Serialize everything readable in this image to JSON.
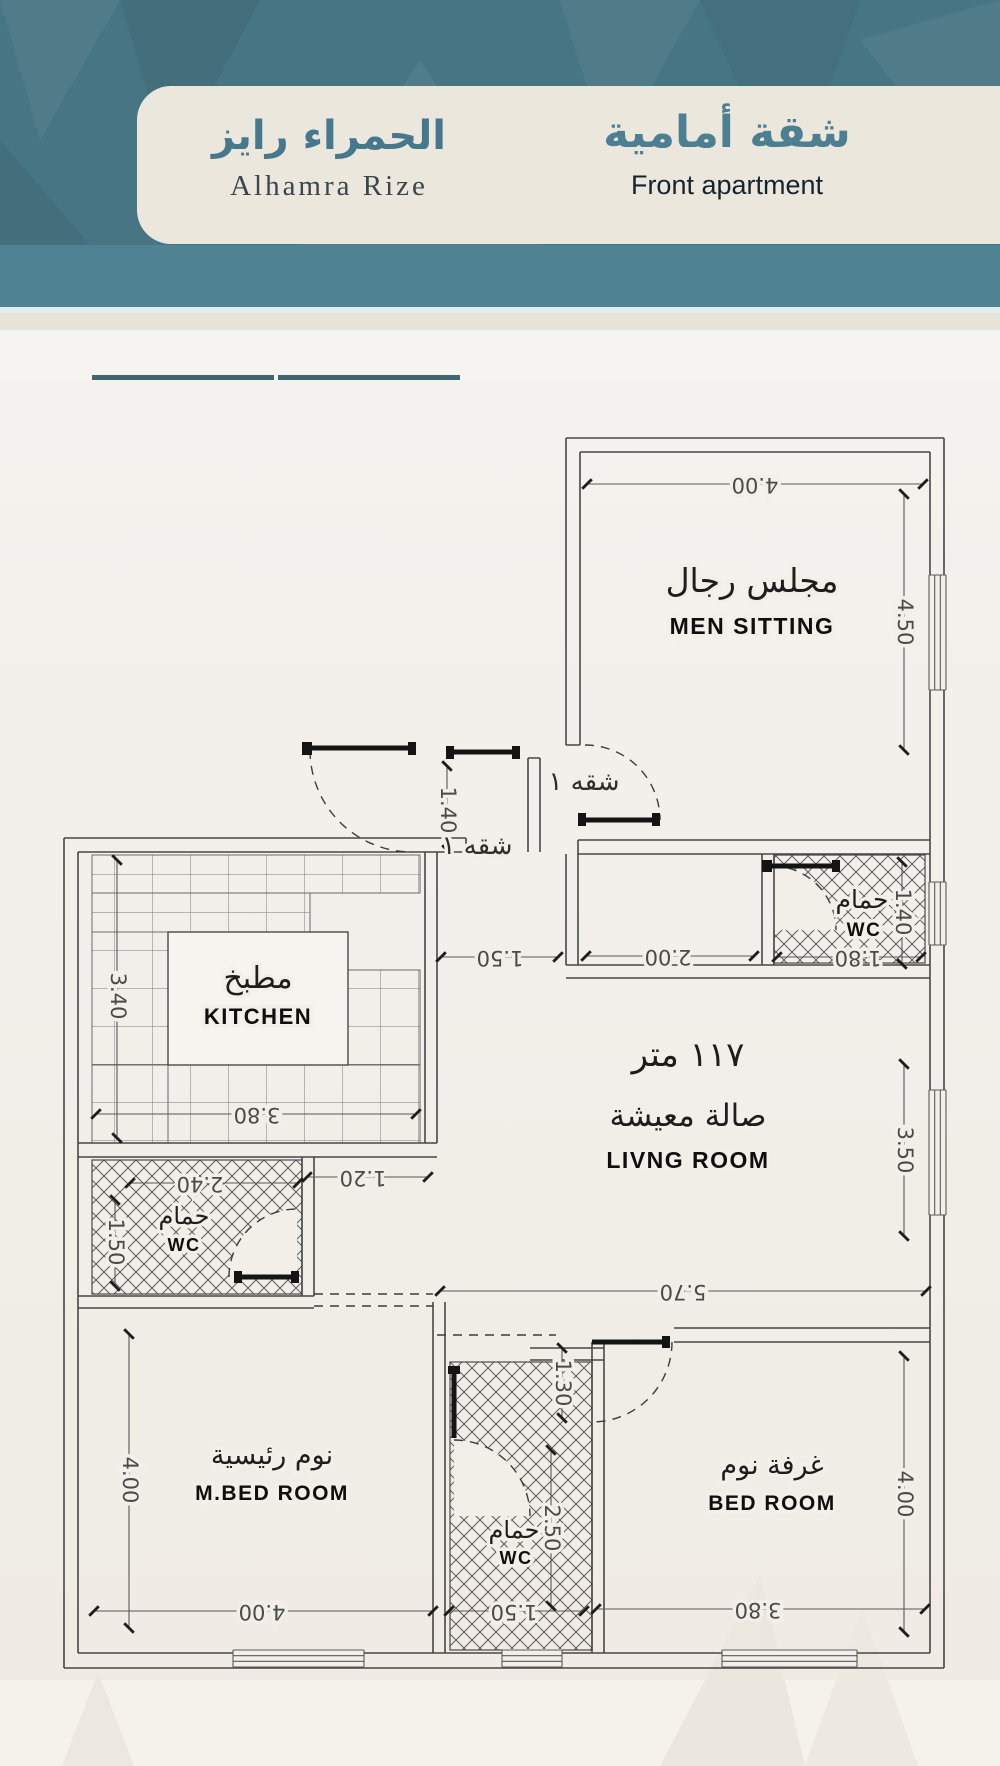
{
  "header": {
    "project_ar": "الحمراء رايز",
    "project_en": "Alhamra Rize",
    "unit_ar": "شقة أمامية",
    "unit_en": "Front apartment"
  },
  "stats": {
    "price": {
      "header": "المساحة",
      "value": "570",
      "unit": "ألف"
    },
    "area": {
      "header": "المساحة",
      "value": "120",
      "unit": "متر مربع"
    }
  },
  "features": {
    "rows": [
      {
        "right": {
          "icon": "room-3d-icon",
          "label": "3 غــــــرف"
        },
        "left": {
          "icon": "sofa-lamp-icon",
          "label": "صالة معيشة"
        }
      },
      {
        "right": {
          "icon": "door-icon",
          "label": "2 مدخـــــل"
        },
        "left": {
          "icon": "parking-icon",
          "label": "موقف خاص"
        }
      },
      {
        "right": {
          "icon": "bathtub-icon",
          "label": "3 دورات مياه"
        },
        "left": {
          "icon": "cabinet-icon",
          "label": "خزانات مستقلة"
        }
      },
      {
        "right": {
          "icon": "kitchen-icon",
          "label": "مطبــــخ"
        },
        "left": {
          "icon": "chevron-up-icon",
          "label": "دخول ذكي"
        }
      }
    ]
  },
  "plan": {
    "apartment_label_1": "شقه ١",
    "apartment_label_2": "شقه ١",
    "rooms": {
      "men_sitting": {
        "ar": "مجلس رجال",
        "en": "MEN SITTING"
      },
      "kitchen": {
        "ar": "مطبخ",
        "en": "KITCHEN"
      },
      "wc_top": {
        "ar": "حمام",
        "en": "WC"
      },
      "living": {
        "area": "١١٧ متر",
        "ar": "صالة معيشة",
        "en": "LIVNG ROOM"
      },
      "wc_left": {
        "ar": "حمام",
        "en": "WC"
      },
      "master_bed": {
        "ar": "نوم رئيسية",
        "en": "M.BED ROOM"
      },
      "wc_bottom": {
        "ar": "حمام",
        "en": "WC"
      },
      "bedroom": {
        "ar": "غرفة نوم",
        "en": "BED ROOM"
      }
    },
    "dims": {
      "men_width": "4.00",
      "men_height": "4.50",
      "entry_depth": "1.40",
      "corridor_width": "1.50",
      "hall_width": "2.00",
      "wc_top_width": "1.80",
      "wc_top_height": "1.40",
      "kitchen_height": "3.40",
      "kitchen_width": "3.80",
      "wc_left_width": "2.40",
      "wc_left_height": "1.50",
      "passage_width": "1.20",
      "living_height": "3.50",
      "living_width": "5.70",
      "hall_door_width": "1.30",
      "wc_bottom_height": "2.50",
      "master_height": "4.00",
      "master_width": "4.00",
      "wc_bottom_width": "1.50",
      "bedroom_width": "3.80",
      "bedroom_height": "4.00"
    }
  }
}
